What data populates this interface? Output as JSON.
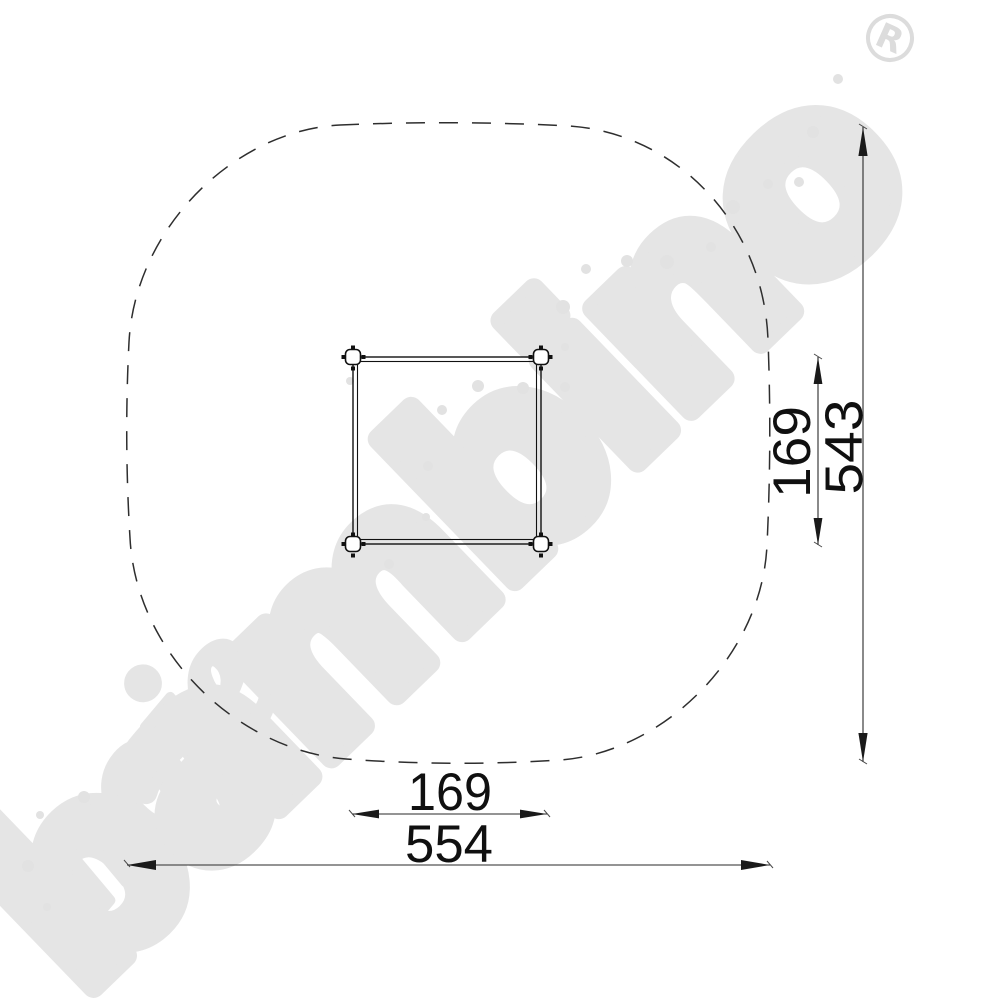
{
  "watermark": {
    "word_small": "moje",
    "word_large": "bambino",
    "registered_mark": "R",
    "color": "#e5e5e5",
    "dot_color": "#e2e2e2",
    "mark_color": "#dcdcdc"
  },
  "dimensions": {
    "outer_width": "554",
    "inner_width": "169",
    "outer_height": "543",
    "inner_height": "169"
  },
  "colors": {
    "boundary_line": "#2e2e2e",
    "structure_line": "#111111",
    "dimension_line": "#2a2a2a",
    "dimension_text": "#101010"
  }
}
